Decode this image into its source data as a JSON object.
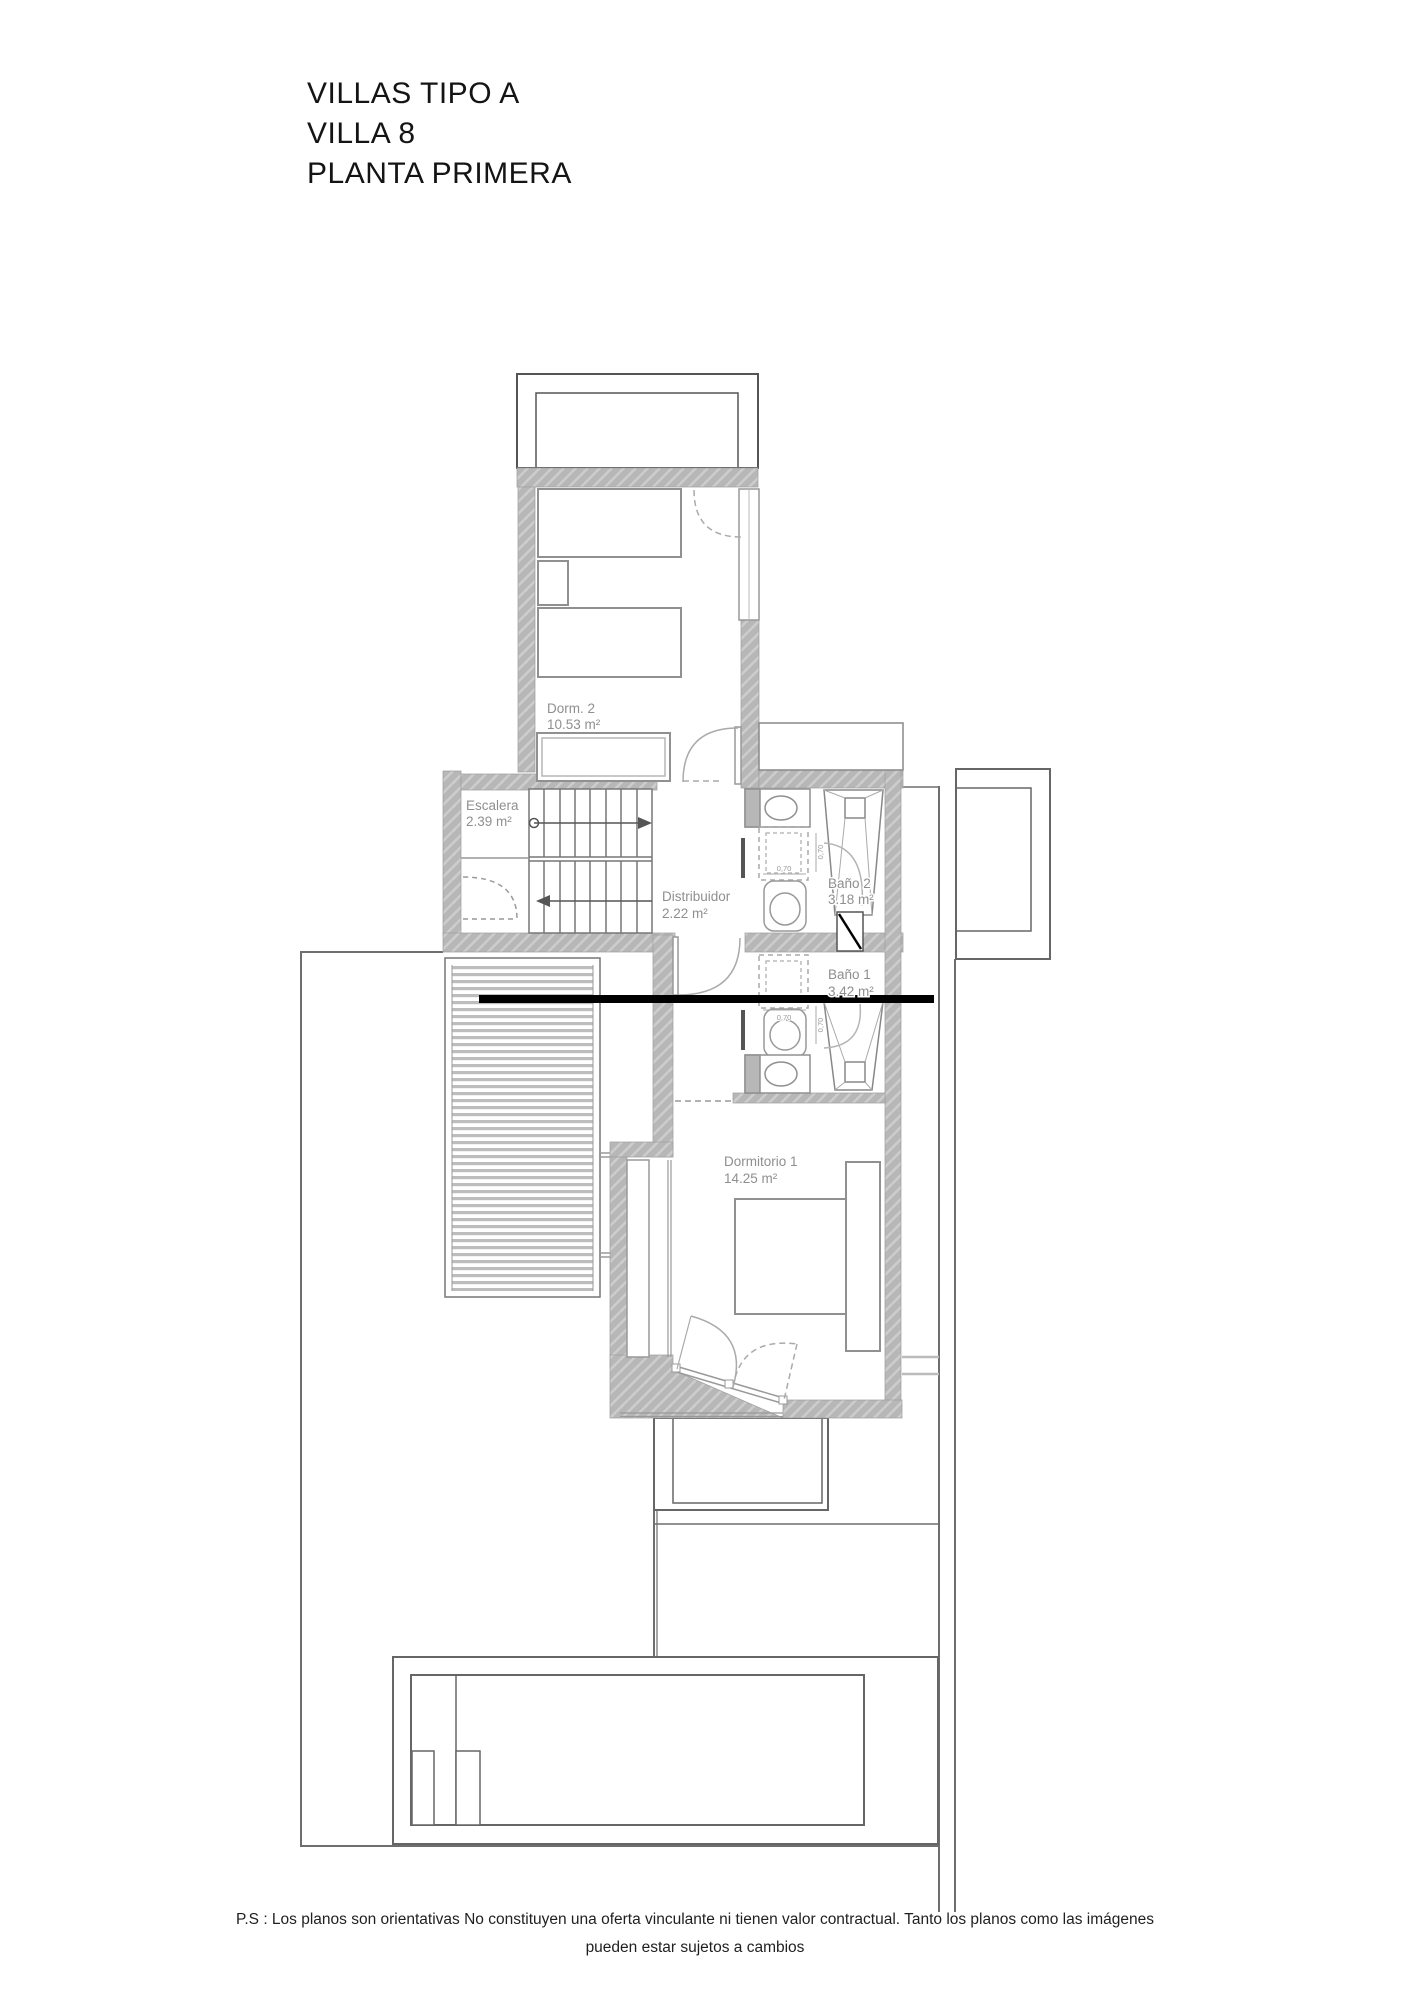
{
  "title": {
    "lines": [
      "VILLAS TIPO A",
      "VILLA 8",
      "PLANTA PRIMERA"
    ]
  },
  "plan": {
    "rooms": [
      {
        "name": "Dorm. 2",
        "area": "10.53 m²"
      },
      {
        "name": "Escalera",
        "area": "2.39 m²"
      },
      {
        "name": "Distribuidor",
        "area": "2.22 m²"
      },
      {
        "name": "Baño 2",
        "area": "3.18 m²"
      },
      {
        "name": "Baño 1",
        "area": "3.42 m²"
      },
      {
        "name": "Dormitorio 1",
        "area": "14.25 m²"
      }
    ],
    "dimension_label": "0,70"
  },
  "footer": {
    "line1": "P.S : Los planos son orientativas No constituyen una oferta vinculante ni tienen valor contractual. Tanto los planos como las imágenes",
    "line2": "pueden estar sujetos a cambios"
  },
  "colors": {
    "wall": "#b7b7b7",
    "line": "#6e6e6e",
    "label": "#8f8f8f",
    "cut_line": "#000000"
  }
}
